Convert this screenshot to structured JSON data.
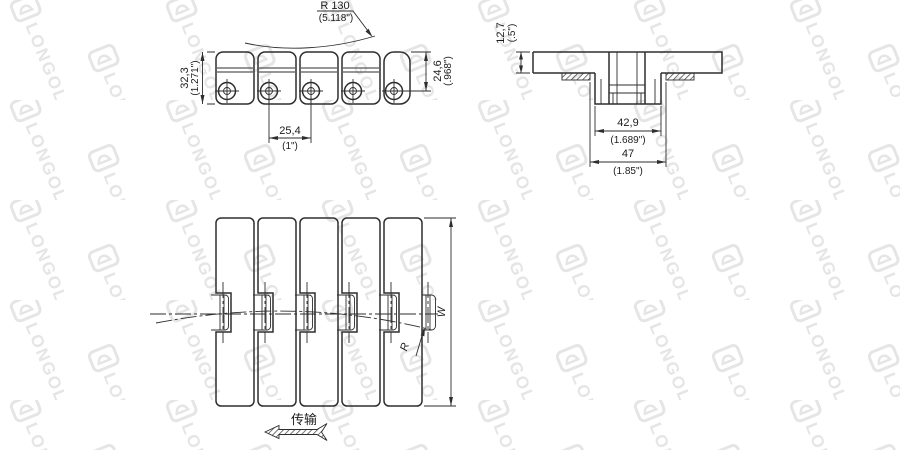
{
  "watermark": {
    "brand": "LONGOLD"
  },
  "side_view": {
    "backflex_radius_mm": "R 130",
    "backflex_radius_in": "(5.118\")",
    "height_mm": "32,3",
    "height_in": "(1.271\")",
    "pin_height_mm": "24,6",
    "pin_height_in": "(.968\")",
    "pitch_mm": "25,4",
    "pitch_in": "(1\")"
  },
  "section_view": {
    "plate_thickness_mm": "12,7",
    "plate_thickness_in": "(.5\")",
    "inner_width_mm": "42,9",
    "inner_width_in": "(1.689\")",
    "outer_width_mm": "47",
    "outer_width_in": "(1.85\")"
  },
  "top_view": {
    "width_label": "W",
    "sideflex_radius_label": "R",
    "direction_label": "传输"
  }
}
